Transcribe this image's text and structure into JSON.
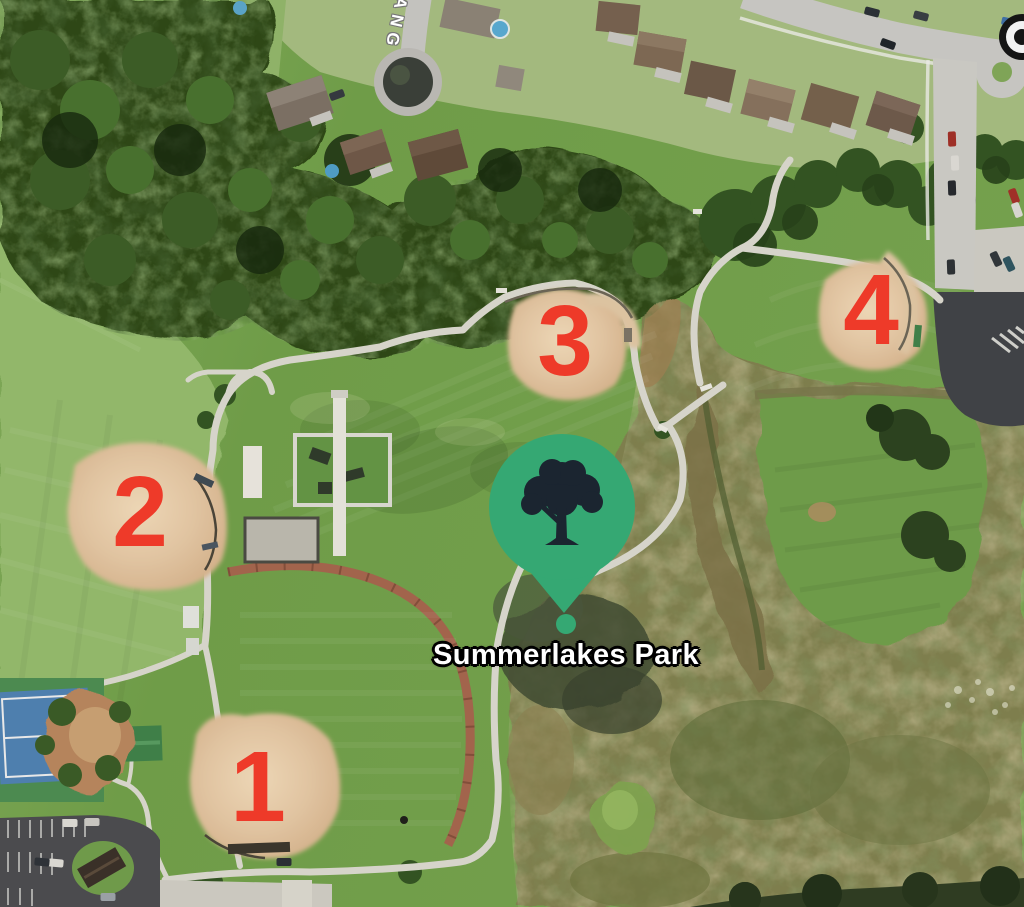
{
  "app": {
    "view": "satellite-map"
  },
  "map": {
    "park_label": "Summerlakes Park",
    "street_label": "ANG",
    "field_markers": [
      {
        "label": "1"
      },
      {
        "label": "2"
      },
      {
        "label": "3"
      },
      {
        "label": "4"
      }
    ],
    "marker": {
      "type": "park-poi",
      "icon": "tree-icon",
      "dot": "anchor-dot"
    },
    "camera_icon": "speed-camera-icon",
    "colors": {
      "annotation": "#ee3a29",
      "pin": "#35a873",
      "pin_icon": "#1b2530",
      "label_text": "#ffffff",
      "label_outline": "#000000",
      "street_text": "#ffffff"
    }
  }
}
